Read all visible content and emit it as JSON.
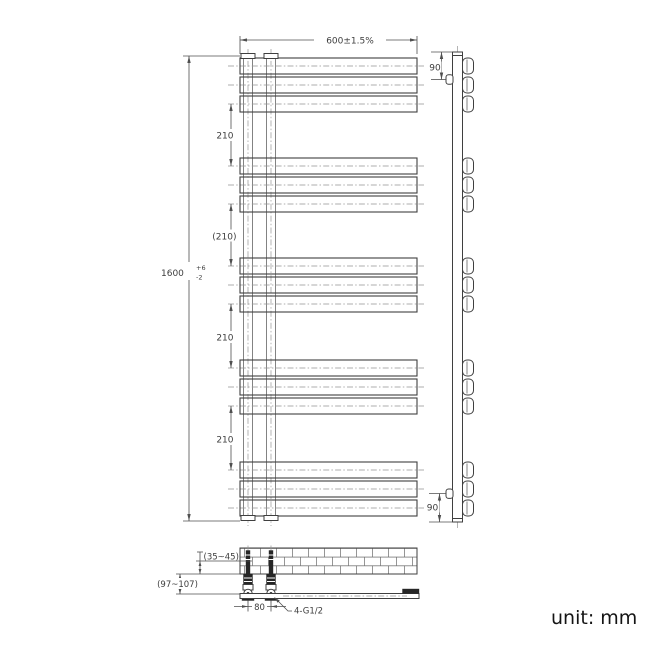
{
  "drawing": {
    "front_view": {
      "width_dim": "600±1.5%",
      "height_dim": "1600",
      "height_tol_plus": "+6",
      "height_tol_minus": "-2",
      "gap_dims": [
        "210",
        "(210)",
        "210",
        "210"
      ]
    },
    "side_view": {
      "top_offset_dim": "90",
      "bottom_offset_dim": "90"
    },
    "installation_view": {
      "pipe_wall_depth_dim": "(35~45)",
      "wall_clearance_dim": "(97~107)",
      "valve_spacing_dim": "80",
      "thread_spec_dim": "4-G1/2"
    },
    "unit_label": "unit: mm"
  }
}
